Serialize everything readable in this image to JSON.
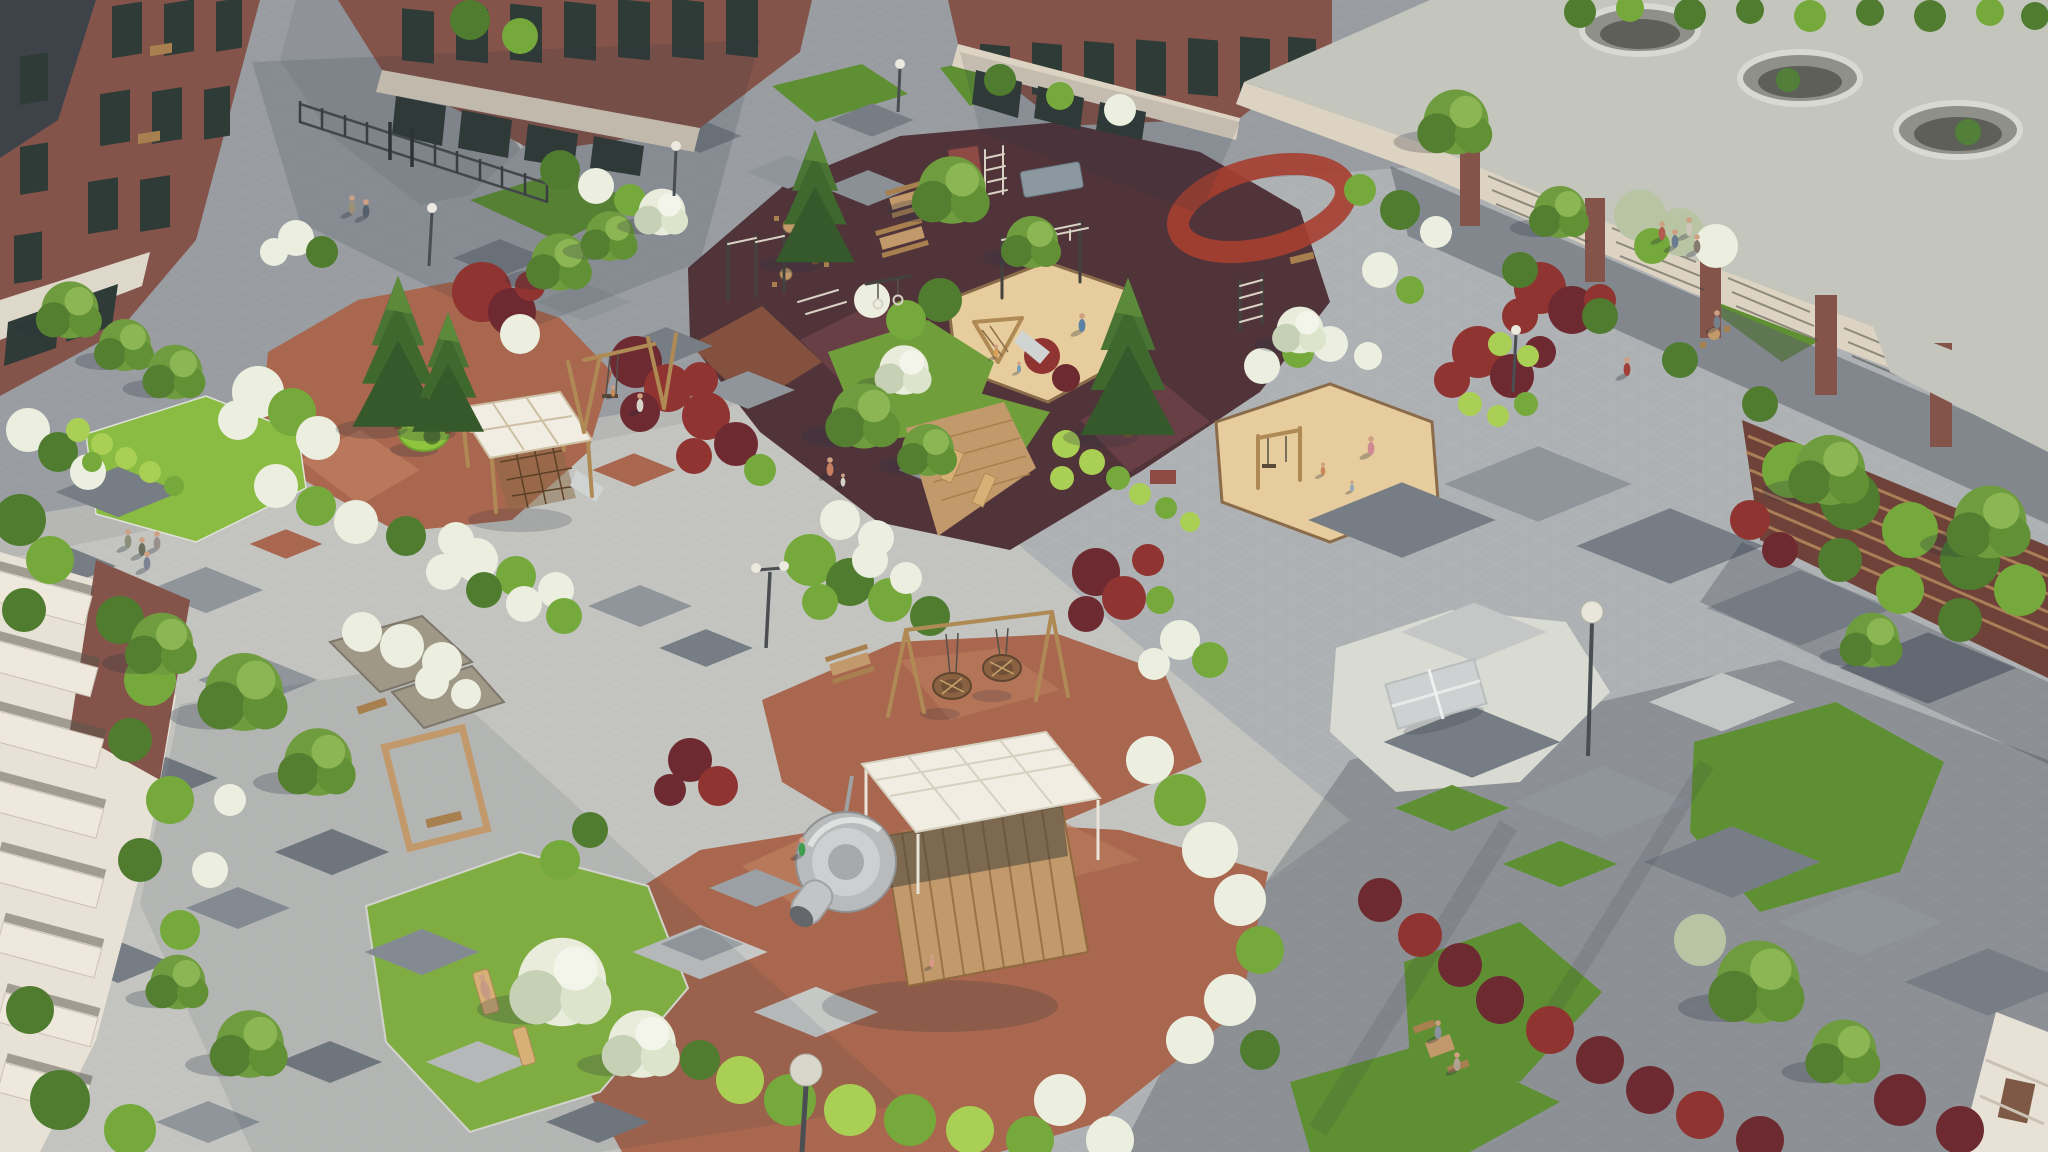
{
  "scene": {
    "type": "architectural-render",
    "view": "aerial-oblique",
    "subject": "Residential courtyard with playgrounds, outdoor fitness zone and landscaped plazas enclosed by brick apartment buildings",
    "lighting": "low sun from upper right, long soft shadows toward lower left",
    "visible_text": "",
    "people_count": 26
  },
  "palette": {
    "pavement": "#aeb1b3",
    "pavement_light": "#d6d5cd",
    "pavement_shade": "#82878f",
    "tile_dark": "#767d84",
    "tile_mid": "#8f959a",
    "tile_light": "#c4c7c5",
    "asphalt": "#8f9399",
    "terracotta": "#a8674e",
    "terracotta_light": "#bd7d5f",
    "rubber_maroon": "#5e3d44",
    "rubber_maroon_light": "#7a4a50",
    "track_red": "#a63f30",
    "sand": "#e7cd9d",
    "gravel_white": "#d9dad2",
    "grass_sun": "#8abb42",
    "grass_mid": "#6f9e3a",
    "grass_shade": "#5f8f33",
    "bush_green": "#76a93c",
    "bush_dark": "#4f7c2e",
    "bush_lime": "#a9cf54",
    "bloom_white": "#ecefe0",
    "silver_green": "#b9c4a4",
    "bush_red": "#8f3431",
    "bush_burgundy": "#6e2a31",
    "conifer": "#3f682e",
    "brick": "#84544a",
    "brick_dark": "#6e4238",
    "roof_dark": "#3e434a",
    "roof_gravel": "#c4c5bd",
    "fascia_cream": "#ddd3c2",
    "window_glass": "#2f3b37",
    "wood": "#c2996a",
    "wood_dark": "#a87f4e",
    "white_structure": "#f1ede2",
    "slide_gray": "#b9babb",
    "balcony_cream": "#e8e2d6"
  },
  "objects": [
    {
      "name": "brick-apartment-building",
      "location": "top-left"
    },
    {
      "name": "brick-apartment-building",
      "location": "top-center"
    },
    {
      "name": "brick-apartment-building",
      "location": "top-center-right"
    },
    {
      "name": "pergola-colonnade",
      "detail": "gravel roof with round skylight openings",
      "location": "top-right"
    },
    {
      "name": "balcony-apartment-building",
      "location": "bottom-left"
    },
    {
      "name": "wood-slat-facade-building",
      "location": "right"
    },
    {
      "name": "entrance-gate-and-fence",
      "location": "top-left"
    },
    {
      "name": "outdoor-fitness-zone",
      "detail": "dark maroon rubber surface with calisthenics equipment",
      "location": "top-center"
    },
    {
      "name": "running-track-loop",
      "location": "right-of-fitness-zone"
    },
    {
      "name": "toddler-play-tower-with-canopy",
      "location": "center-left"
    },
    {
      "name": "green-play-pod",
      "location": "center-left"
    },
    {
      "name": "swing-set",
      "location": "center-left"
    },
    {
      "name": "nest-swings",
      "location": "center"
    },
    {
      "name": "spiral-tube-slide",
      "location": "bottom-center"
    },
    {
      "name": "climbing-cube-with-white-grid-canopy",
      "location": "bottom-center"
    },
    {
      "name": "sandbox-with-climbing-frame",
      "location": "center"
    },
    {
      "name": "sandbox-with-swing-frame",
      "location": "center-right"
    },
    {
      "name": "table-tennis-table",
      "location": "center-right on white gravel"
    },
    {
      "name": "wooden-deck-with-loungers",
      "location": "center"
    },
    {
      "name": "picnic-tables",
      "location": "center and top-left"
    },
    {
      "name": "cafe-tables-and-chairs",
      "location": "top-left"
    },
    {
      "name": "wooden-arch-with-bench",
      "location": "bottom-left"
    },
    {
      "name": "sun-loungers-on-lawn",
      "location": "bottom-left"
    },
    {
      "name": "stone-planters-with-white-grasses",
      "location": "center-left"
    },
    {
      "name": "street-lamps",
      "location": "throughout"
    },
    {
      "name": "diamond-accent-paving-tiles",
      "location": "plazas"
    },
    {
      "name": "flower-beds",
      "detail": "white blooming, red, burgundy and green shrubs",
      "location": "throughout"
    },
    {
      "name": "spruce-trees",
      "location": "center-left and center"
    },
    {
      "name": "pedestrians",
      "location": "throughout"
    }
  ]
}
